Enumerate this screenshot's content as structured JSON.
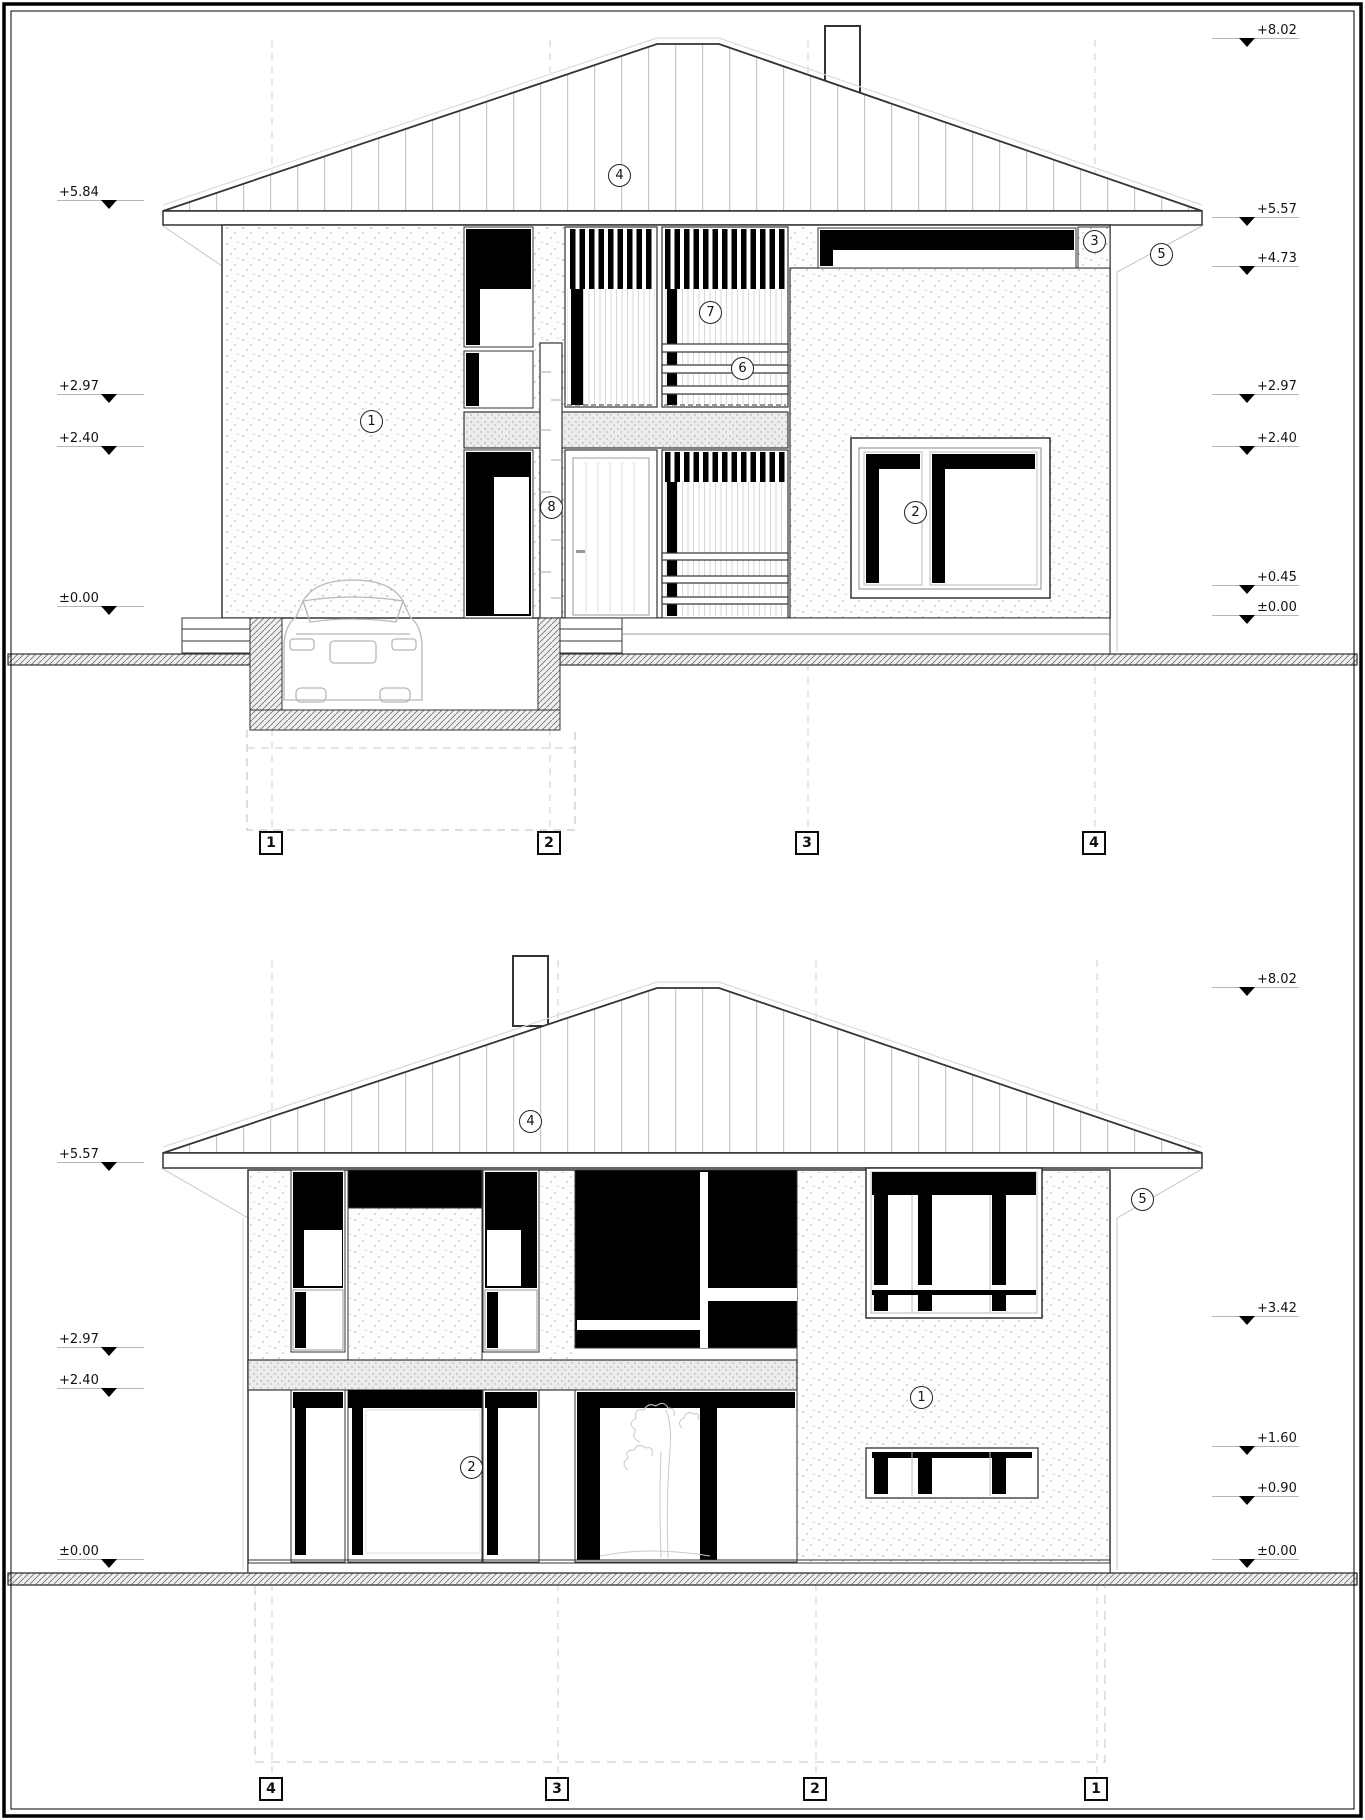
{
  "top_elevation": {
    "left_markers": [
      {
        "label": "+5.84"
      },
      {
        "label": "+2.97"
      },
      {
        "label": "+2.40"
      },
      {
        "label": "±0.00"
      }
    ],
    "right_markers": [
      {
        "label": "+8.02"
      },
      {
        "label": "+5.57"
      },
      {
        "label": "+4.73"
      },
      {
        "label": "+2.97"
      },
      {
        "label": "+2.40"
      },
      {
        "label": "+0.45"
      },
      {
        "label": "±0.00"
      }
    ],
    "callouts": {
      "wall": "1",
      "window": "2",
      "band": "3",
      "roof": "4",
      "eave": "5",
      "railing": "6",
      "louvers": "7",
      "pilaster": "8"
    },
    "grid_labels": [
      "1",
      "2",
      "3",
      "4"
    ]
  },
  "bottom_elevation": {
    "left_markers": [
      {
        "label": "+5.57"
      },
      {
        "label": "+2.97"
      },
      {
        "label": "+2.40"
      },
      {
        "label": "±0.00"
      }
    ],
    "right_markers": [
      {
        "label": "+8.02"
      },
      {
        "label": "+3.42"
      },
      {
        "label": "+1.60"
      },
      {
        "label": "+0.90"
      },
      {
        "label": "±0.00"
      }
    ],
    "callouts": {
      "wall": "1",
      "window": "2",
      "roof": "4",
      "eave": "5"
    },
    "grid_labels": [
      "4",
      "3",
      "2",
      "1"
    ]
  },
  "colors": {
    "line": "#333333",
    "glazing": "#000000",
    "light_line": "#c4c4c4"
  }
}
